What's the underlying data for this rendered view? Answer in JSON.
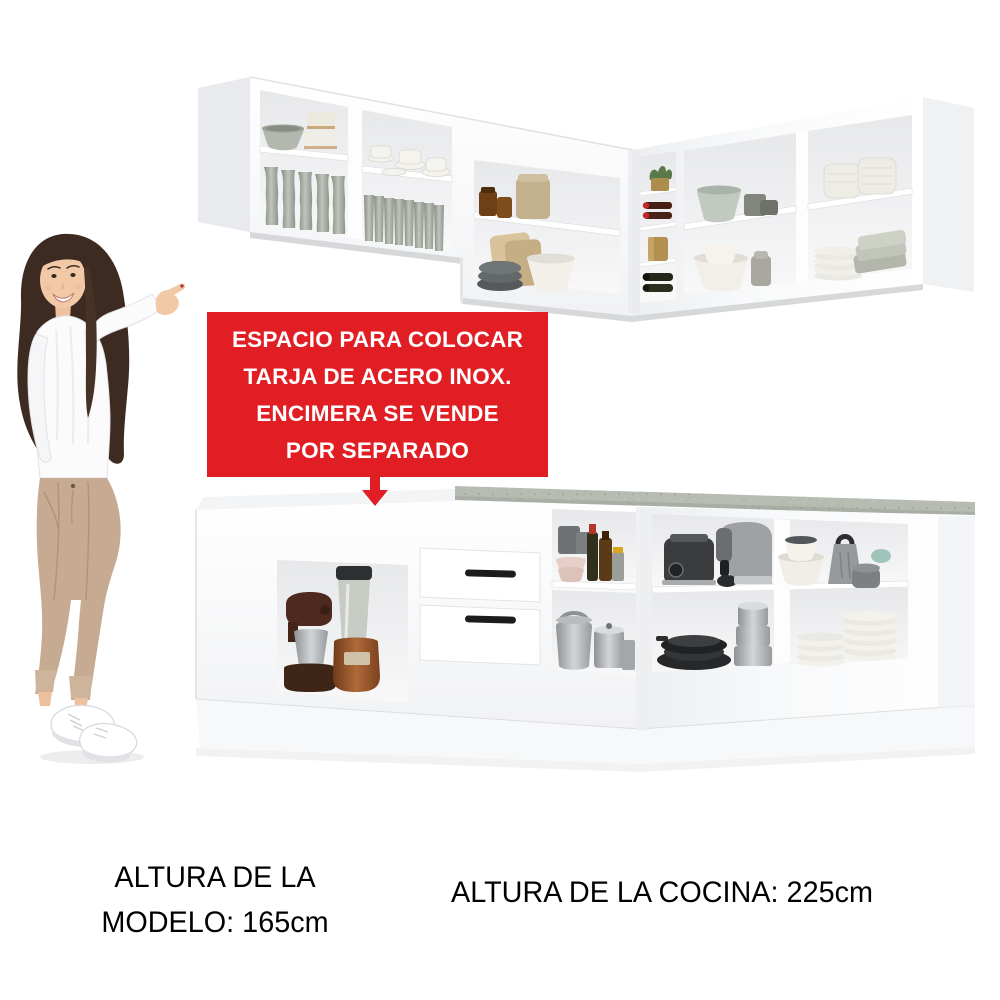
{
  "callout": {
    "lines": [
      "ESPACIO PARA COLOCAR",
      "TARJA DE ACERO INOX.",
      "ENCIMERA SE VENDE",
      "POR SEPARADO"
    ],
    "bg_color": "#E01E24",
    "text_color": "#FFFFFF",
    "arrow_icon": "down-arrow"
  },
  "captions": {
    "model_height_line1": "ALTURA DE LA",
    "model_height_line2": "MODELO: 165cm",
    "kitchen_height": "ALTURA DE LA COCINA: 225cm"
  },
  "colors": {
    "accent_red": "#E01E24",
    "countertop": "#B6BCB1",
    "cabinet_white": "#FFFFFF",
    "caption_text": "#000000"
  }
}
